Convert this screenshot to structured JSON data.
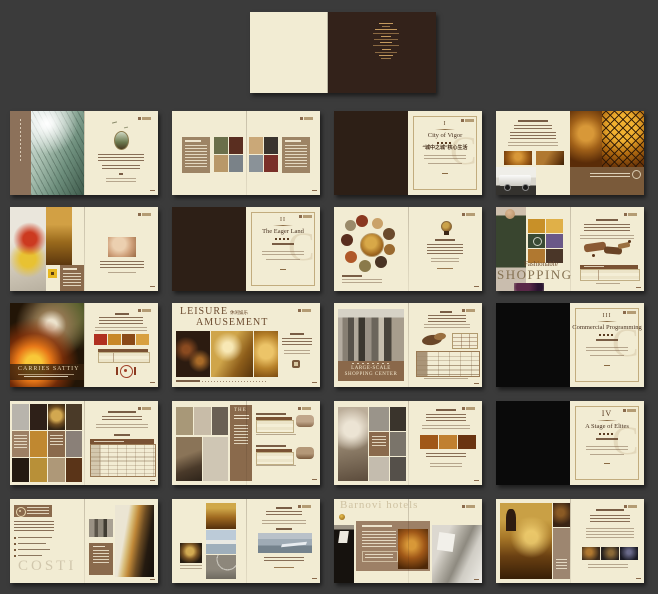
{
  "palette": {
    "backdrop": "#3b3b3b",
    "cream_page": "#f2ecd3",
    "cover_brown": "#33221a",
    "chapter_brown": "#2d1f16",
    "black_page": "#0a0a0a",
    "panel_taupe": "#9d8668",
    "band_brown": "#8a6a4c",
    "ink_brown": "#64442c",
    "gold_text": "#c49a5e"
  },
  "icons": {
    "emblem": "oval-crest-badge",
    "dining": "plate-and-cutlery-ring",
    "globe": "globe-trophy",
    "oval_logo": "oval-seal",
    "gold_ball": "gold-sphere"
  },
  "chapters": [
    {
      "numeral": "I",
      "script_title": "City of Vigor",
      "cn_title": "“城中之城”核心生活",
      "watermark_letter": "C"
    },
    {
      "numeral": "II",
      "script_title": "The Eager Land",
      "cn_title": "",
      "watermark_letter": "C"
    },
    {
      "numeral": "III",
      "script_title": "Commercial Programming",
      "cn_title": "",
      "watermark_letter": "C"
    },
    {
      "numeral": "IV",
      "script_title": "A Stage of Elites",
      "cn_title": "",
      "watermark_letter": "C"
    }
  ],
  "titles": {
    "carries": "CARRIES SATTIY",
    "leisure": "LEISURE",
    "leisure_cn": "休闲娱乐",
    "amusement": "AMUSEMENT",
    "large_scale_1": "LARGE-SCALE",
    "large_scale_2": "SHOPPING CENTER",
    "fashionable": "Fashionable",
    "shopping": "SHOPPING",
    "the_panel": "THE",
    "costi_watermark": "COSTI",
    "hotels_watermark": "Barnovi hotels"
  }
}
